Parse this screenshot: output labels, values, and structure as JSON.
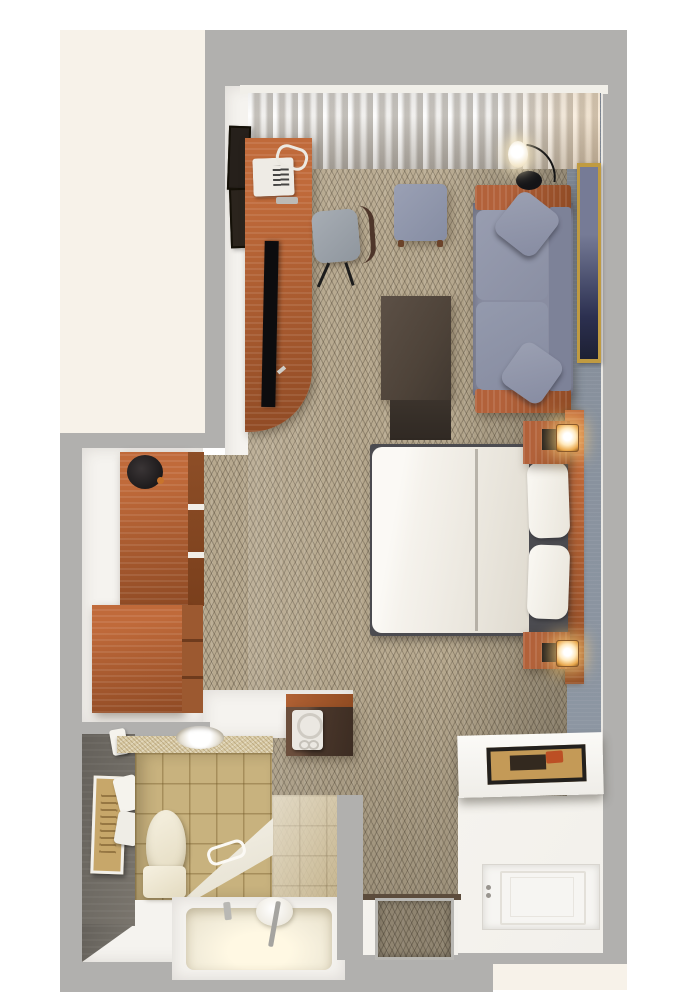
{
  "scene": {
    "title": "Top-down 3D floor plan render of a studio hotel suite",
    "rooms": [
      {
        "name": "living-sleeping-area",
        "floor": "beige herringbone carpet",
        "wall": "slate blue-gray accent wall on right, sheer curtains along window wall at top",
        "furniture": [
          "wood desk with telephone, remote and flat-screen TV",
          "desk chair",
          "blue-gray ottoman",
          "dark walnut coffee table",
          "blue-gray sofa with wood arms and two throw pillows",
          "arc floor lamp",
          "gold-framed wall art",
          "bed with white duvet and two pillows",
          "wood headboard",
          "two wood nightstands with lit sconce lamps",
          "two framed pictures on entry wall"
        ]
      },
      {
        "name": "closet-dressing-area",
        "floor": "white",
        "furniture": [
          "tall wardrobe cabinet with dark bag on top",
          "wood dresser with drawers"
        ]
      },
      {
        "name": "kitchenette-nook",
        "furniture": [
          "coffee maker on dark wood counter with cherry trim"
        ]
      },
      {
        "name": "bathroom",
        "floor": "tan ceramic tile",
        "wall": "dark taupe accent wall with framed art and towels",
        "furniture": [
          "speckled vanity counter with round sink",
          "toilet",
          "tub deck with grab bar",
          "soaking tub with chrome faucet"
        ]
      },
      {
        "name": "entry-hall",
        "floor": "white",
        "furniture": [
          "white console shelf with framed picture",
          "white paneled entry door",
          "carpet door mat"
        ]
      }
    ],
    "outside": [
      "cream adjacent area top-left",
      "cream adjacent area bottom-right",
      "light gray exterior wall band"
    ]
  },
  "colors": {
    "outside_bg": "#ffffff",
    "exterior_cream": "#f7f2e9",
    "wall_gray": "#b1b0ae",
    "interior_white": "#f5f3ef",
    "slate_wall": "#87909c",
    "carpet": "#b7a98f",
    "curtain_light": "#eceae6",
    "curtain_dark": "#c8c4be",
    "cherry": "#b2613a",
    "cherry_dark": "#8f4a24",
    "walnut": "#4e4339",
    "sofa_fabric": "#898da1",
    "pillow_fabric": "#9297aa",
    "duvet": "#f5f2ec",
    "bed_frame": "#4b4b50",
    "tile": "#c8b27e",
    "bath_wall": "#6f6b64",
    "counter_tan": "#d9cba6",
    "bone": "#efe8d6",
    "entry_floor": "#f2f0eb",
    "tv_black": "#0c0c0e",
    "chrome": "#bcbab6",
    "lamp_glow": "#ffd98f",
    "art_gold": "#c09b41",
    "art_navy": "#2c3050",
    "door_white": "#f6f5f2"
  }
}
